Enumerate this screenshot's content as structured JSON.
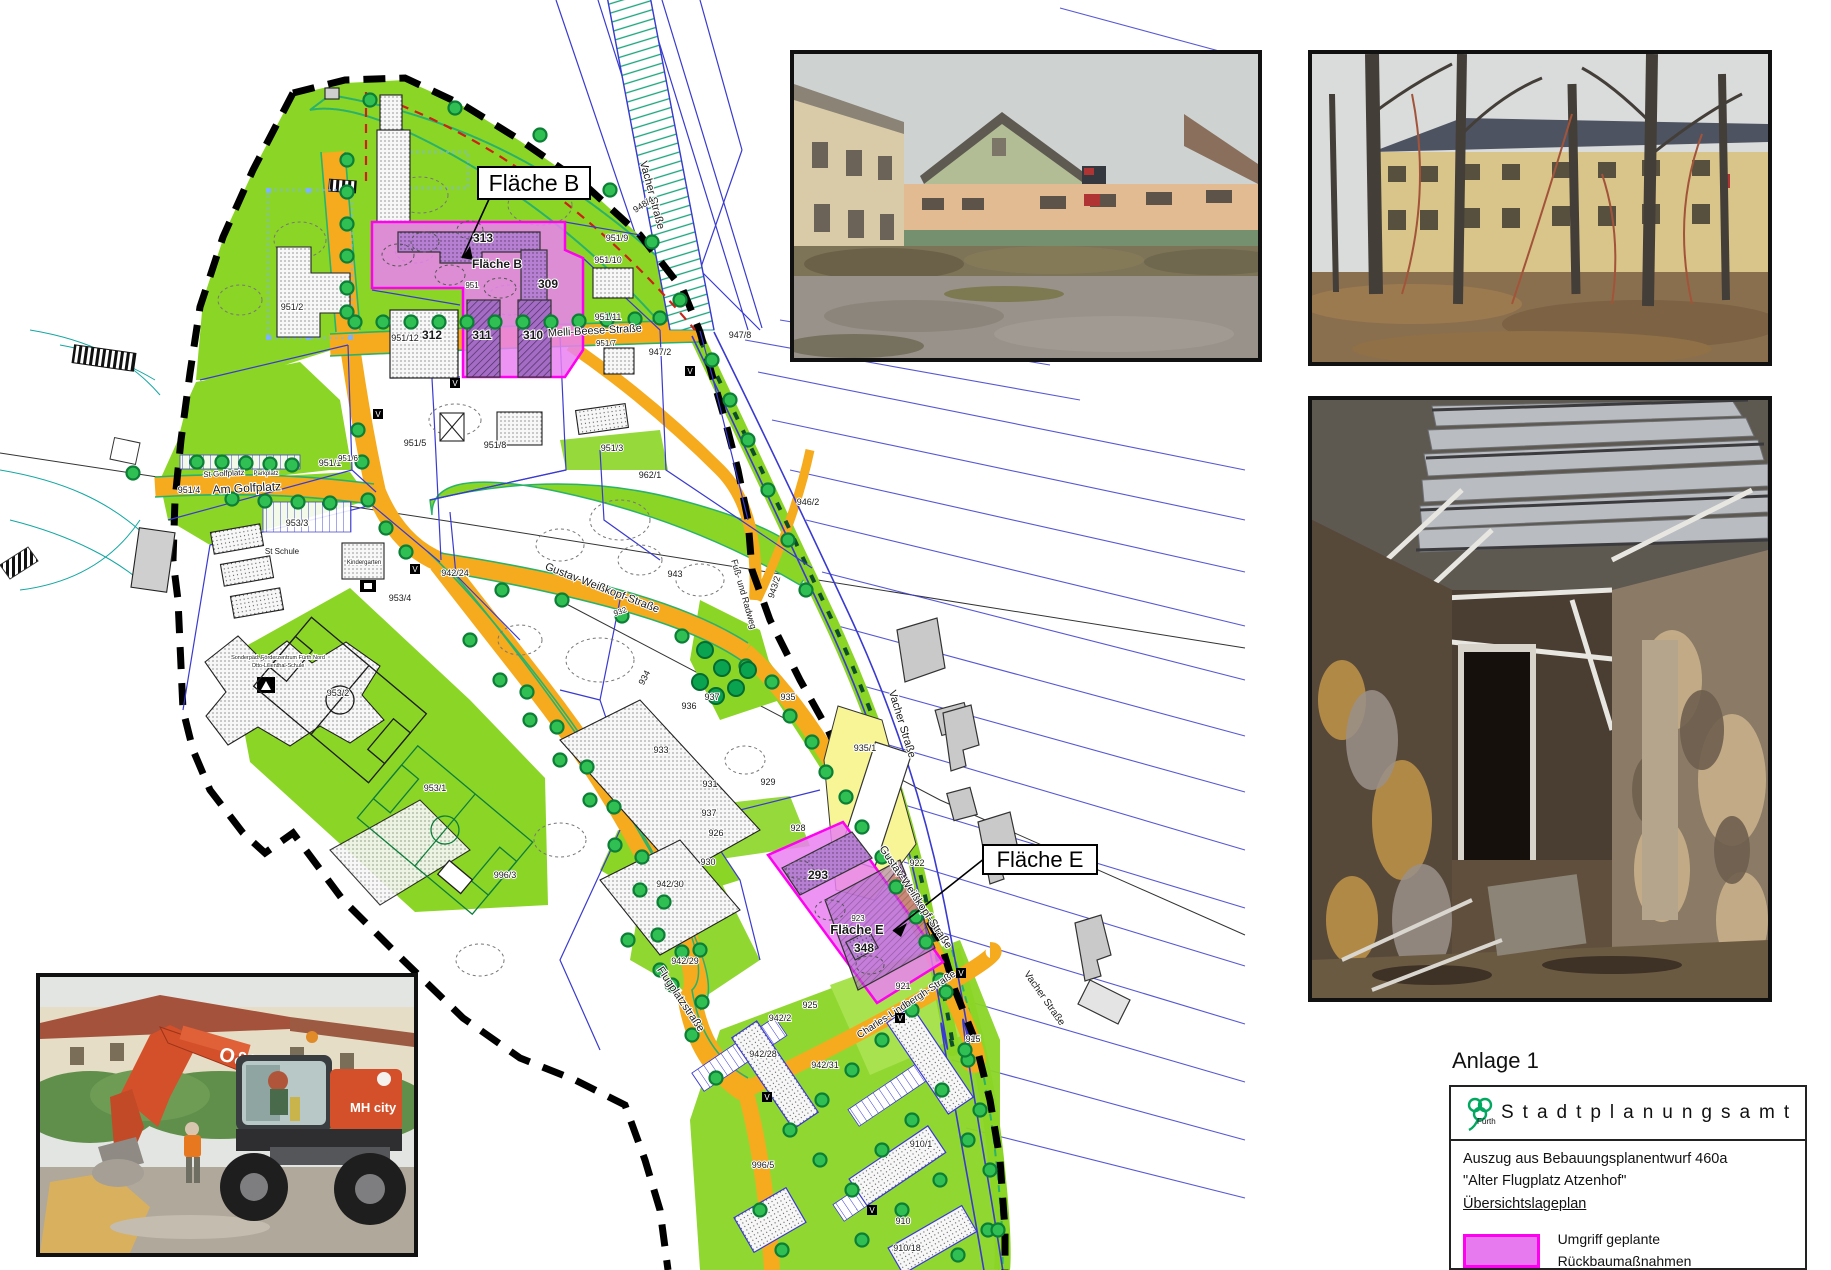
{
  "legend": {
    "anlage": "Anlage 1",
    "office": "Stadtplanungsamt",
    "logo_city": "Fürth",
    "line1": "Auszug aus Bebauungsplanentwurf 460a",
    "line2": "\"Alter Flugplatz Atzenhof\"",
    "line3": "Übersichtslageplan",
    "swatch_label": "Umgriff geplante Rückbaumaßnahmen",
    "swatch_fill": "#e87af0",
    "swatch_border": "#ff00f0"
  },
  "map": {
    "callout_b": "Fläche B",
    "callout_e": "Fläche E",
    "marker_letter": "V",
    "labels": [
      {
        "t": "Melli-Beese-Straße",
        "x": 595,
        "y": 334,
        "s": 11,
        "r": -3
      },
      {
        "t": "Am Golfplatz",
        "x": 247,
        "y": 492,
        "s": 12,
        "r": -3
      },
      {
        "t": "St Golfplatz",
        "x": 224,
        "y": 476,
        "s": 8,
        "r": -3
      },
      {
        "t": "Parkplatz",
        "x": 266,
        "y": 475,
        "s": 6,
        "r": 0
      },
      {
        "t": "Gustav-Weißkopf-Straße",
        "x": 601,
        "y": 591,
        "s": 11,
        "r": 21
      },
      {
        "t": "Gustav-Weißkopf-Straße",
        "x": 913,
        "y": 899,
        "s": 11,
        "r": 56
      },
      {
        "t": "Flugplatzstraße",
        "x": 678,
        "y": 1001,
        "s": 11,
        "r": 56
      },
      {
        "t": "Charles-Lindbergh-Straße",
        "x": 908,
        "y": 1007,
        "s": 10,
        "r": -33
      },
      {
        "t": "Vacher Straße",
        "x": 649,
        "y": 196,
        "s": 11,
        "r": 75
      },
      {
        "t": "Vacher Straße",
        "x": 899,
        "y": 725,
        "s": 11,
        "r": 73
      },
      {
        "t": "Vacher Straße",
        "x": 1042,
        "y": 1000,
        "s": 10,
        "r": 55
      },
      {
        "t": "Fuß- und Radweg",
        "x": 741,
        "y": 595,
        "s": 9,
        "r": 74
      },
      {
        "t": "951/2",
        "x": 292,
        "y": 310,
        "s": 9
      },
      {
        "t": "951/4",
        "x": 189,
        "y": 493,
        "s": 9
      },
      {
        "t": "951/1",
        "x": 330,
        "y": 466,
        "s": 9
      },
      {
        "t": "951/5",
        "x": 415,
        "y": 446,
        "s": 9
      },
      {
        "t": "951/6",
        "x": 348,
        "y": 461,
        "s": 8
      },
      {
        "t": "951/8",
        "x": 495,
        "y": 448,
        "s": 9
      },
      {
        "t": "951/3",
        "x": 612,
        "y": 451,
        "s": 9
      },
      {
        "t": "962/1",
        "x": 650,
        "y": 478,
        "s": 9
      },
      {
        "t": "946/2",
        "x": 808,
        "y": 505,
        "s": 9
      },
      {
        "t": "943",
        "x": 675,
        "y": 577,
        "s": 9
      },
      {
        "t": "943/2",
        "x": 777,
        "y": 588,
        "s": 9,
        "r": -72
      },
      {
        "t": "934",
        "x": 647,
        "y": 679,
        "s": 9,
        "r": -62
      },
      {
        "t": "932",
        "x": 621,
        "y": 614,
        "s": 8,
        "r": -20
      },
      {
        "t": "933",
        "x": 661,
        "y": 753,
        "s": 9
      },
      {
        "t": "936",
        "x": 689,
        "y": 709,
        "s": 9
      },
      {
        "t": "937",
        "x": 712,
        "y": 700,
        "s": 9
      },
      {
        "t": "937",
        "x": 709,
        "y": 816,
        "s": 9
      },
      {
        "t": "931",
        "x": 710,
        "y": 787,
        "s": 9
      },
      {
        "t": "929",
        "x": 768,
        "y": 785,
        "s": 9
      },
      {
        "t": "926",
        "x": 716,
        "y": 836,
        "s": 9
      },
      {
        "t": "930",
        "x": 708,
        "y": 865,
        "s": 9
      },
      {
        "t": "928",
        "x": 798,
        "y": 831,
        "s": 9
      },
      {
        "t": "925",
        "x": 810,
        "y": 1008,
        "s": 9
      },
      {
        "t": "942/24",
        "x": 455,
        "y": 576,
        "s": 9
      },
      {
        "t": "942/30",
        "x": 670,
        "y": 887,
        "s": 9
      },
      {
        "t": "942/29",
        "x": 685,
        "y": 964,
        "s": 9
      },
      {
        "t": "942/28",
        "x": 763,
        "y": 1057,
        "s": 9
      },
      {
        "t": "942/31",
        "x": 825,
        "y": 1068,
        "s": 9
      },
      {
        "t": "942/2",
        "x": 780,
        "y": 1021,
        "s": 9
      },
      {
        "t": "996/3",
        "x": 505,
        "y": 878,
        "s": 9
      },
      {
        "t": "996/5",
        "x": 763,
        "y": 1168,
        "s": 9
      },
      {
        "t": "910/1",
        "x": 921,
        "y": 1147,
        "s": 9
      },
      {
        "t": "910",
        "x": 903,
        "y": 1224,
        "s": 9
      },
      {
        "t": "910/18",
        "x": 907,
        "y": 1251,
        "s": 9
      },
      {
        "t": "915",
        "x": 973,
        "y": 1042,
        "s": 9
      },
      {
        "t": "921",
        "x": 903,
        "y": 989,
        "s": 9
      },
      {
        "t": "922",
        "x": 917,
        "y": 866,
        "s": 9
      },
      {
        "t": "923",
        "x": 858,
        "y": 921,
        "s": 8
      },
      {
        "t": "935",
        "x": 788,
        "y": 700,
        "s": 9
      },
      {
        "t": "935/1",
        "x": 865,
        "y": 751,
        "s": 9
      },
      {
        "t": "948/4",
        "x": 645,
        "y": 207,
        "s": 9,
        "r": -33
      },
      {
        "t": "951/9",
        "x": 617,
        "y": 241,
        "s": 9
      },
      {
        "t": "951/10",
        "x": 608,
        "y": 263,
        "s": 9
      },
      {
        "t": "951/11",
        "x": 608,
        "y": 320,
        "s": 9
      },
      {
        "t": "951/7",
        "x": 606,
        "y": 346,
        "s": 8
      },
      {
        "t": "947/2",
        "x": 660,
        "y": 355,
        "s": 9
      },
      {
        "t": "947/8",
        "x": 740,
        "y": 338,
        "s": 9
      },
      {
        "t": "951/12",
        "x": 405,
        "y": 341,
        "s": 9
      },
      {
        "t": "951",
        "x": 472,
        "y": 288,
        "s": 8
      },
      {
        "t": "953/4",
        "x": 400,
        "y": 601,
        "s": 9
      },
      {
        "t": "953/3",
        "x": 297,
        "y": 526,
        "s": 9
      },
      {
        "t": "953/2",
        "x": 338,
        "y": 696,
        "s": 9
      },
      {
        "t": "953/1",
        "x": 435,
        "y": 791,
        "s": 9
      },
      {
        "t": "313",
        "x": 483,
        "y": 242,
        "s": 12,
        "b": 1
      },
      {
        "t": "309",
        "x": 548,
        "y": 288,
        "s": 12,
        "b": 1
      },
      {
        "t": "312",
        "x": 432,
        "y": 339,
        "s": 12,
        "b": 1
      },
      {
        "t": "311",
        "x": 482,
        "y": 339,
        "s": 12,
        "b": 1
      },
      {
        "t": "310",
        "x": 533,
        "y": 339,
        "s": 12,
        "b": 1
      },
      {
        "t": "293",
        "x": 818,
        "y": 879,
        "s": 12,
        "b": 1
      },
      {
        "t": "348",
        "x": 864,
        "y": 952,
        "s": 12,
        "b": 1
      },
      {
        "t": "Fläche B",
        "x": 497,
        "y": 268,
        "s": 12,
        "b": 1
      },
      {
        "t": "Fläche E",
        "x": 857,
        "y": 934,
        "s": 13,
        "b": 1
      },
      {
        "t": "St Schule",
        "x": 282,
        "y": 554,
        "s": 8
      },
      {
        "t": "Kindergarten",
        "x": 364,
        "y": 564,
        "s": 6
      },
      {
        "t": "Sonderpäd. Förderzentrum Fürth Nord",
        "x": 278,
        "y": 659,
        "s": 5.5
      },
      {
        "t": "Otto-Lilienthal-Schule",
        "x": 278,
        "y": 667,
        "s": 5.5
      }
    ],
    "markers": [
      {
        "x": 455,
        "y": 383
      },
      {
        "x": 690,
        "y": 371
      },
      {
        "x": 378,
        "y": 414
      },
      {
        "x": 415,
        "y": 569
      },
      {
        "x": 900,
        "y": 1018
      },
      {
        "x": 767,
        "y": 1097
      },
      {
        "x": 872,
        "y": 1210
      },
      {
        "x": 961,
        "y": 973
      }
    ]
  },
  "photos": {
    "excavator_brand": "O&K",
    "excavator_model": "MH city"
  },
  "colors": {
    "green": "#8bd526",
    "orange": "#f6ab1e",
    "magenta_border": "#ff00f0",
    "magenta_fill": "#ea80f2",
    "building_purple": "#b77fd2",
    "yellow": "#f7f596",
    "blue_line": "#3a3ad0",
    "teal_line": "#12a7a2",
    "red_dash": "#cc2018"
  }
}
